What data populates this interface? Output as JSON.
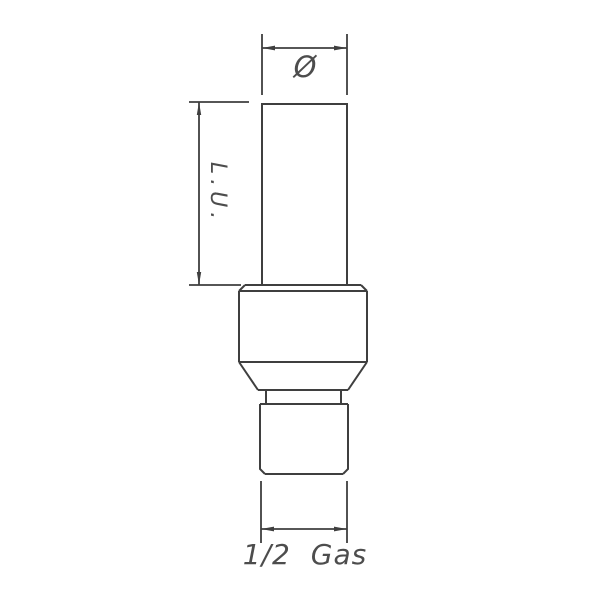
{
  "page": {
    "background_color": "#ffffff",
    "line_color": "#3f3f3f",
    "text_color": "#4d4d4d"
  },
  "drawing": {
    "labels": {
      "diameter_symbol": "Ø",
      "useful_length": "L.U.",
      "thread_size": "1/2 Gas"
    }
  }
}
